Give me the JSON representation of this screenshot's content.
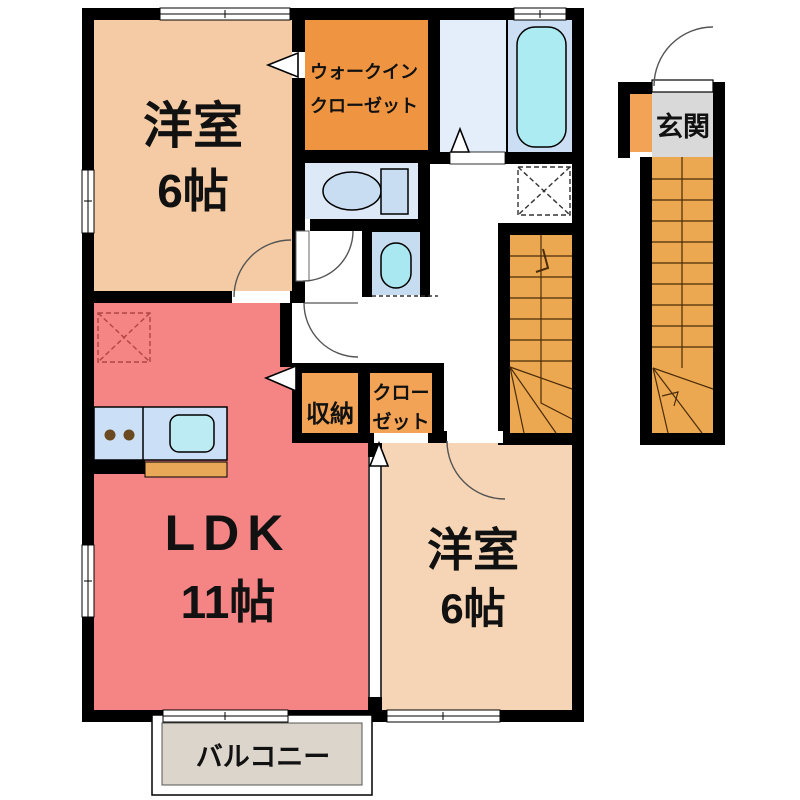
{
  "rooms": {
    "bedroom_top": {
      "name": "洋室",
      "size": "6帖"
    },
    "walk_in_closet": {
      "line1": "ウォークイン",
      "line2": "クローゼット"
    },
    "entrance": {
      "name": "玄関"
    },
    "storage": {
      "name": "収納"
    },
    "closet": {
      "line1": "クロー",
      "line2": "ゼット"
    },
    "ldk": {
      "name": "LDK",
      "size": "11帖"
    },
    "bedroom_bottom": {
      "name": "洋室",
      "size": "6帖"
    },
    "balcony": {
      "name": "バルコニー"
    }
  },
  "colors": {
    "wall": "#000000",
    "bedroom_top_fill": "#F4CBA4",
    "bedroom_bottom_fill": "#F5D5B5",
    "ldk_fill": "#F58484",
    "walk_in_closet_fill": "#EF9542",
    "storage_fill": "#F2A355",
    "stairs_fill": "#ECA851",
    "entrance_fill": "#D9D9D9",
    "bath_fill": "#CBDEF3",
    "washroom_fill": "#E3EEFA",
    "toilet_fill": "#DDE9F6",
    "vanity_fill": "#C6DCF1",
    "tub_fill": "#ADEBF3",
    "balcony_fill": "#DBD5CC",
    "kitchen_counter_fill": "#CBE0F6",
    "kitchen_sink_fill": "#BCEBF3",
    "kitchen_strip_fill": "#E8A857"
  }
}
